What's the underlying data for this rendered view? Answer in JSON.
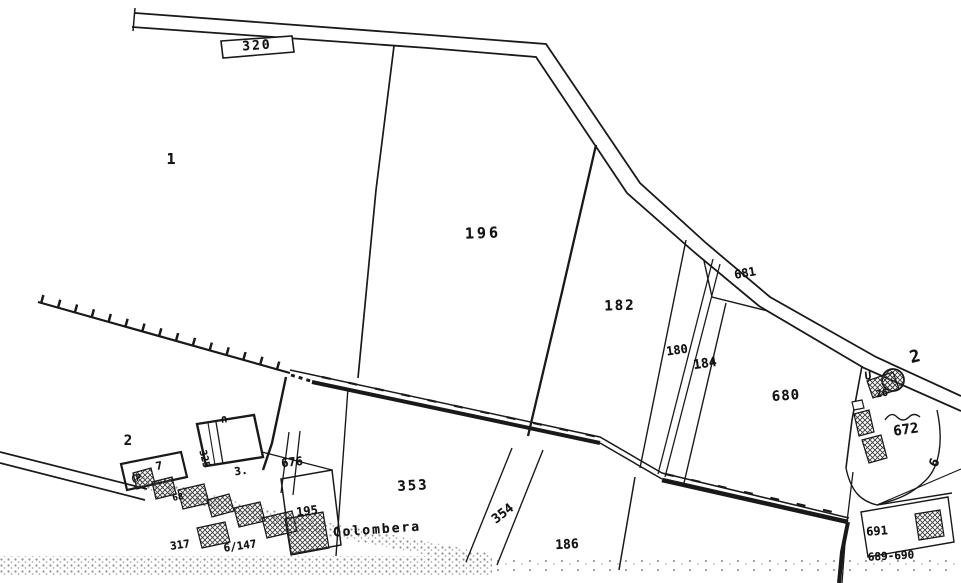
{
  "map": {
    "kind": "cadastral-map-scan",
    "place_name": "Colombera",
    "road_number": "320",
    "colors": {
      "ink": "#1c1c1c",
      "paper": "#ffffff",
      "stipple": "#8f8f8f"
    },
    "symbols": [
      {
        "name": "circle-landmark-symbol"
      },
      {
        "name": "railway-tick-line"
      },
      {
        "name": "hatched-building"
      },
      {
        "name": "stippled-road-band"
      }
    ],
    "labels": [
      {
        "name": "road-label-320",
        "text": "320",
        "x": 257,
        "y": 46,
        "rot": -4,
        "size": 13,
        "ls": 2
      },
      {
        "name": "parcel-label-1",
        "text": "1",
        "x": 171,
        "y": 159,
        "rot": 0,
        "size": 15
      },
      {
        "name": "parcel-label-196",
        "text": "196",
        "x": 483,
        "y": 233,
        "rot": -2,
        "size": 15,
        "ls": 3
      },
      {
        "name": "parcel-label-182",
        "text": "182",
        "x": 620,
        "y": 306,
        "rot": -2,
        "size": 14,
        "ls": 2
      },
      {
        "name": "parcel-label-180",
        "text": "180",
        "x": 677,
        "y": 350,
        "rot": -8,
        "size": 12
      },
      {
        "name": "parcel-label-184",
        "text": "184",
        "x": 705,
        "y": 364,
        "rot": -8,
        "size": 13
      },
      {
        "name": "parcel-label-681",
        "text": "681",
        "x": 745,
        "y": 273,
        "rot": -10,
        "size": 12
      },
      {
        "name": "parcel-label-680",
        "text": "680",
        "x": 786,
        "y": 396,
        "rot": -4,
        "size": 14,
        "ls": 1
      },
      {
        "name": "parcel-label-2-east",
        "text": "2",
        "x": 915,
        "y": 357,
        "rot": -14,
        "size": 17
      },
      {
        "name": "parcel-label-672",
        "text": "672",
        "x": 906,
        "y": 430,
        "rot": -8,
        "size": 14
      },
      {
        "name": "parcel-label-6",
        "text": "6",
        "x": 935,
        "y": 463,
        "rot": -65,
        "size": 13
      },
      {
        "name": "label-26",
        "text": "26",
        "x": 882,
        "y": 394,
        "rot": -10,
        "size": 10
      },
      {
        "name": "symbol-u",
        "text": "U",
        "x": 868,
        "y": 376,
        "rot": -5,
        "size": 11
      },
      {
        "name": "parcel-label-2-west",
        "text": "2",
        "x": 128,
        "y": 441,
        "rot": 0,
        "size": 14
      },
      {
        "name": "label-7",
        "text": "7",
        "x": 159,
        "y": 466,
        "rot": -10,
        "size": 11
      },
      {
        "name": "label-p",
        "text": "(P",
        "x": 136,
        "y": 479,
        "rot": -8,
        "size": 9
      },
      {
        "name": "label-68",
        "text": "68",
        "x": 178,
        "y": 498,
        "rot": -10,
        "size": 9
      },
      {
        "name": "label-325",
        "text": "325",
        "x": 204,
        "y": 459,
        "rot": 76,
        "size": 10
      },
      {
        "name": "parcel-label-3",
        "text": "3.",
        "x": 241,
        "y": 471,
        "rot": -8,
        "size": 11
      },
      {
        "name": "symbol-arch",
        "text": "∩",
        "x": 224,
        "y": 419,
        "rot": -6,
        "size": 11
      },
      {
        "name": "parcel-label-676",
        "text": "676",
        "x": 292,
        "y": 462,
        "rot": -6,
        "size": 12
      },
      {
        "name": "parcel-label-195",
        "text": "195",
        "x": 307,
        "y": 511,
        "rot": -7,
        "size": 12
      },
      {
        "name": "parcel-label-353",
        "text": "353",
        "x": 413,
        "y": 486,
        "rot": -3,
        "size": 14,
        "ls": 2
      },
      {
        "name": "place-label-colombera",
        "text": "Colombera",
        "x": 377,
        "y": 530,
        "rot": -4,
        "size": 13,
        "ls": 2
      },
      {
        "name": "parcel-label-354",
        "text": "354",
        "x": 503,
        "y": 514,
        "rot": -38,
        "size": 13
      },
      {
        "name": "parcel-label-186",
        "text": "186",
        "x": 567,
        "y": 545,
        "rot": -3,
        "size": 13
      },
      {
        "name": "label-317",
        "text": "317",
        "x": 180,
        "y": 545,
        "rot": -8,
        "size": 11
      },
      {
        "name": "label-6-147",
        "text": "6/147",
        "x": 240,
        "y": 546,
        "rot": -8,
        "size": 11
      },
      {
        "name": "parcel-label-691",
        "text": "691",
        "x": 877,
        "y": 531,
        "rot": -4,
        "size": 12
      },
      {
        "name": "parcel-label-689-690",
        "text": "689-690",
        "x": 891,
        "y": 556,
        "rot": -3,
        "size": 11
      }
    ]
  }
}
